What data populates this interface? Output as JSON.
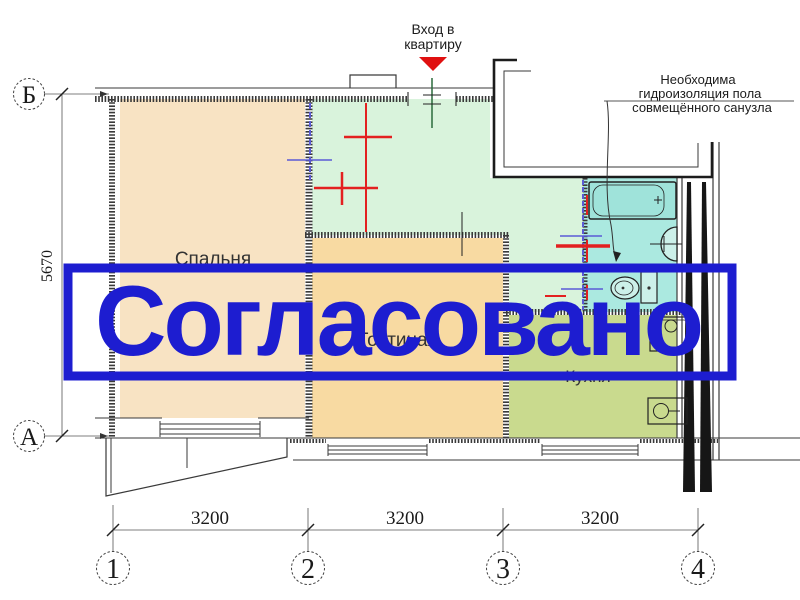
{
  "stamp": {
    "text": "Согласовано",
    "color": "#1d1dd0"
  },
  "plan": {
    "rooms": {
      "bedroom": "Спальня",
      "living": "Гостиная",
      "kitchen": "Кухня"
    },
    "room_colors": {
      "bedroom": "#f8e3c3",
      "living": "#f8daa2",
      "hall": "#d9f3dc",
      "bathroom": "#abe9e0",
      "kitchen": "#c9da8e",
      "bathtub": "#9fe3da",
      "fixture": "#ccf0e9"
    },
    "entrance": {
      "line1": "Вход в",
      "line2": "квартиру",
      "arrow_color": "#e01010"
    },
    "note": {
      "line1": "Необходима",
      "line2": "гидроизоляция пола",
      "line3": "совмещённого санузла"
    },
    "marks": {
      "red": "#e32020",
      "blue": "#5b5bd6",
      "green": "#2a6b3c"
    }
  },
  "axes": {
    "left": [
      "Б",
      "А"
    ],
    "bottom": [
      "1",
      "2",
      "3",
      "4"
    ]
  },
  "dimensions": {
    "vertical": "5670",
    "bottom": [
      "3200",
      "3200",
      "3200"
    ]
  }
}
